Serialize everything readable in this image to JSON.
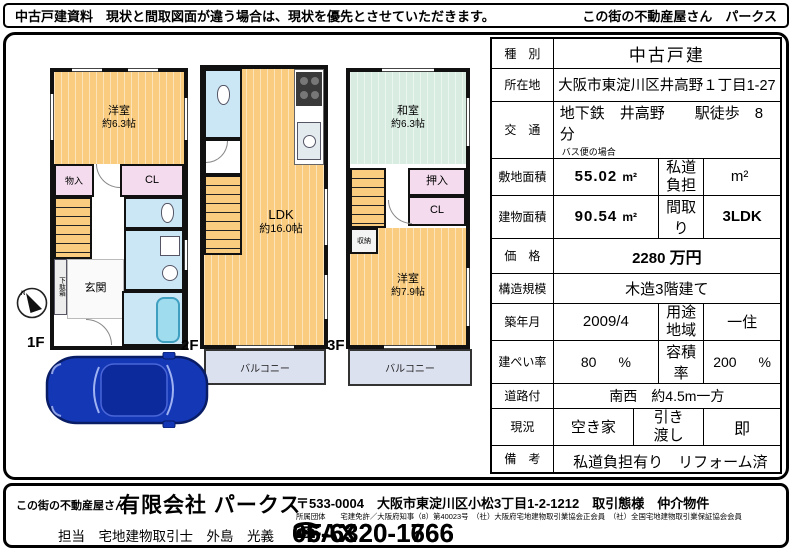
{
  "header": {
    "notice": "中古戸建資料　現状と間取図面が違う場合は、現状を優先とさせていただきます。",
    "brand": "この街の不動産屋さん　パークス"
  },
  "plans": {
    "compass_n": "N",
    "f1": {
      "label": "1F",
      "yoshitsu_name": "洋室",
      "yoshitsu_size": "約6.3帖",
      "monoire": "物入",
      "cl": "CL",
      "getabako": "下駄箱",
      "genkan": "玄関"
    },
    "f2": {
      "label": "2F",
      "ldk_name": "LDK",
      "ldk_size": "約16.0帖",
      "balcony": "バルコニー"
    },
    "f3": {
      "label": "3F",
      "washitsu_name": "和室",
      "washitsu_size": "約6.3帖",
      "oshiire": "押入",
      "cl": "CL",
      "shuno": "収納",
      "yoshitsu_name": "洋室",
      "yoshitsu_size": "約7.9帖",
      "balcony": "バルコニー"
    }
  },
  "spec": {
    "type": {
      "label": "種　別",
      "value": "中古戸建"
    },
    "location": {
      "label": "所在地",
      "value": "大阪市東淀川区井高野１丁目1-27"
    },
    "access": {
      "label": "交　通",
      "value": "地下鉄　井高野　　駅徒歩　8　分",
      "note": "バス便の場合"
    },
    "land": {
      "label": "敷地面積",
      "value": "55.02",
      "unit": "m²",
      "sub_label": "私道\n負担",
      "sub_unit": "m²"
    },
    "building": {
      "label": "建物面積",
      "value": "90.54",
      "unit": "m²",
      "sub_label": "間取り",
      "sub_value": "3LDK"
    },
    "price": {
      "label": "価　格",
      "value": "2280",
      "unit": "万円"
    },
    "structure": {
      "label": "構造規模",
      "value": "木造3階建て"
    },
    "built": {
      "label": "築年月",
      "value": "2009/4",
      "sub_label": "用途\n地域",
      "sub_value": "一住"
    },
    "coverage": {
      "label": "建ぺい率",
      "value": "80",
      "unit": "%",
      "sub_label": "容積率",
      "sub_value": "200",
      "sub_unit": "%"
    },
    "road": {
      "label": "道路付",
      "value": "南西　約4.5m一方"
    },
    "status": {
      "label": "現況",
      "value": "空き家",
      "sub_label": "引き\n渡し",
      "sub_value": "即"
    },
    "remarks": {
      "label": "備　考",
      "value": "私道負担有り　リフォーム済"
    }
  },
  "footer": {
    "tagline": "この街の不動産屋さん",
    "company": "有限会社 パークス",
    "address": "〒533-0004　大阪市東淀川区小松3丁目1-2-1212　取引態様　仲介物件",
    "memberships": "所属団体　　宅建免許／大阪府知事（8）第40023号　（社）大阪府宅地建物取引業協会正会員　（社）全国宅地建物取引業保証協会会員",
    "staff": "担当　宅地建物取引士　外島　光義",
    "phone_icon": "☎",
    "tel": "06-6320-1666",
    "fax_label": "FAX",
    "fax": "06-6320-1766"
  },
  "palette": {
    "room_orange": "#F9CC80",
    "tatami_green": "#D9ECE2",
    "closet_pink": "#F4DCEE",
    "water_blue": "#CBE7F5",
    "balcony_blue": "#DCE1F0",
    "car_blue": "#1437B5"
  }
}
